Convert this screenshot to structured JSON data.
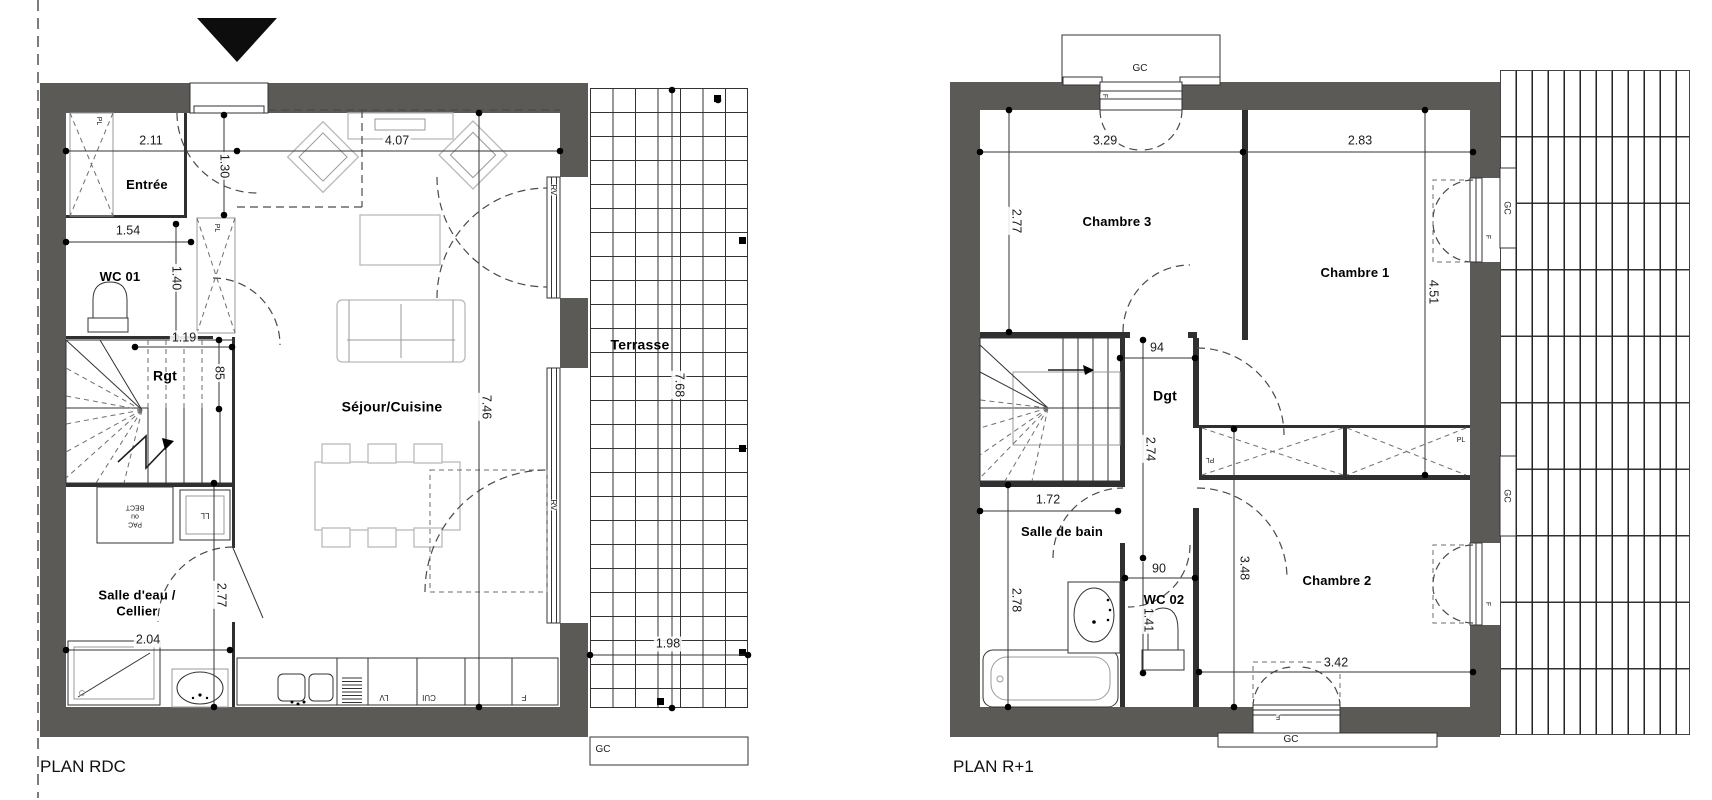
{
  "document": {
    "type": "architectural floor plan drawing",
    "units": "meters"
  },
  "colors": {
    "wall": "#5b5a57",
    "line": "#333333",
    "furniture": "#b9b9b9",
    "dim_text": "#1b1b1b",
    "background": "#ffffff"
  },
  "plans": [
    {
      "title": "PLAN RDC",
      "level": "ground floor",
      "rooms": [
        "Entrée",
        "WC 01",
        "Rgt",
        "Séjour/Cuisine",
        "Salle d'eau / Cellier",
        "Terrasse"
      ],
      "dimensions": [
        "2.11",
        "4.07",
        "1.30",
        "1.54",
        "1.40",
        "1.19",
        "85",
        "7.46",
        "2.77",
        "2.04",
        "7.68",
        "1.98"
      ],
      "equipment_codes": [
        "PL",
        "RV",
        "LL",
        "PAC ou BECT",
        "LV",
        "CUI",
        "F",
        "GC"
      ]
    },
    {
      "title": "PLAN R+1",
      "level": "first floor",
      "rooms": [
        "Chambre 3",
        "Chambre 1",
        "Chambre 2",
        "Dgt",
        "Salle de bain",
        "WC 02"
      ],
      "dimensions": [
        "3.29",
        "2.83",
        "2.77",
        "4.51",
        "94",
        "2.74",
        "1.72",
        "2.78",
        "90",
        "1.41",
        "3.48",
        "3.42"
      ],
      "equipment_codes": [
        "GC",
        "F",
        "PL"
      ]
    }
  ],
  "labels": {
    "rooms": [
      {
        "t": "Entrée",
        "x": 147,
        "y": 185
      },
      {
        "t": "WC 01",
        "x": 120,
        "y": 277
      },
      {
        "t": "Rgt",
        "x": 165,
        "y": 376,
        "fs": 14
      },
      {
        "t": "Séjour/Cuisine",
        "x": 392,
        "y": 407,
        "fs": 14
      },
      {
        "t": "Salle d'eau /\nCellier",
        "x": 137,
        "y": 603
      },
      {
        "t": "Terrasse",
        "x": 640,
        "y": 345,
        "fs": 14
      },
      {
        "t": "Chambre 3",
        "x": 1117,
        "y": 222
      },
      {
        "t": "Chambre 1",
        "x": 1355,
        "y": 273
      },
      {
        "t": "Chambre 2",
        "x": 1337,
        "y": 581
      },
      {
        "t": "Dgt",
        "x": 1165,
        "y": 396,
        "fs": 14
      },
      {
        "t": "Salle de bain",
        "x": 1062,
        "y": 532
      },
      {
        "t": "WC 02",
        "x": 1164,
        "y": 600
      }
    ],
    "dimensions": [
      {
        "t": "2.11",
        "x": 151,
        "y": 141
      },
      {
        "t": "4.07",
        "x": 397,
        "y": 141
      },
      {
        "t": "1.30",
        "x": 224,
        "y": 166,
        "r": 90
      },
      {
        "t": "1.54",
        "x": 128,
        "y": 231
      },
      {
        "t": "1.40",
        "x": 176,
        "y": 278,
        "r": 90
      },
      {
        "t": "1.19",
        "x": 184,
        "y": 338
      },
      {
        "t": "85",
        "x": 219,
        "y": 373,
        "r": 90
      },
      {
        "t": "7.46",
        "x": 486,
        "y": 407,
        "r": 90
      },
      {
        "t": "2.77",
        "x": 221,
        "y": 595,
        "r": 90
      },
      {
        "t": "2.04",
        "x": 148,
        "y": 640
      },
      {
        "t": "7.68",
        "x": 679,
        "y": 385,
        "r": 90
      },
      {
        "t": "1.98",
        "x": 668,
        "y": 644
      },
      {
        "t": "3.29",
        "x": 1105,
        "y": 141
      },
      {
        "t": "2.83",
        "x": 1360,
        "y": 141
      },
      {
        "t": "2.77",
        "x": 1016,
        "y": 221,
        "r": 90
      },
      {
        "t": "4.51",
        "x": 1433,
        "y": 292,
        "r": 90
      },
      {
        "t": "94",
        "x": 1157,
        "y": 348
      },
      {
        "t": "2.74",
        "x": 1150,
        "y": 449,
        "r": 90
      },
      {
        "t": "1.72",
        "x": 1048,
        "y": 500
      },
      {
        "t": "2.78",
        "x": 1016,
        "y": 600,
        "r": 90
      },
      {
        "t": "90",
        "x": 1159,
        "y": 569
      },
      {
        "t": "1.41",
        "x": 1148,
        "y": 620,
        "r": 90
      },
      {
        "t": "3.48",
        "x": 1244,
        "y": 568,
        "r": 90
      },
      {
        "t": "3.42",
        "x": 1336,
        "y": 663
      }
    ],
    "annotations": [
      {
        "t": "PL",
        "x": 98,
        "y": 121,
        "r": 90,
        "fs": 7
      },
      {
        "t": "PL",
        "x": 216,
        "y": 228,
        "r": 90,
        "fs": 7
      },
      {
        "t": "RV",
        "x": 553,
        "y": 190,
        "r": 90,
        "fs": 8
      },
      {
        "t": "RV",
        "x": 553,
        "y": 505,
        "r": 90,
        "fs": 8
      },
      {
        "t": "PAC\nou\nBECT",
        "x": 135,
        "y": 515,
        "r": 180,
        "fs": 7
      },
      {
        "t": "LL",
        "x": 205,
        "y": 515,
        "r": 180,
        "fs": 8
      },
      {
        "t": "LV",
        "x": 384,
        "y": 697,
        "r": 180,
        "fs": 8
      },
      {
        "t": "CUI",
        "x": 429,
        "y": 697,
        "r": 180,
        "fs": 8
      },
      {
        "t": "F",
        "x": 524,
        "y": 697,
        "r": 180,
        "fs": 8
      },
      {
        "t": "GC",
        "x": 603,
        "y": 750,
        "fs": 10
      },
      {
        "t": "GC",
        "x": 1140,
        "y": 69,
        "fs": 10
      },
      {
        "t": "F",
        "x": 1104,
        "y": 96,
        "r": 90,
        "fs": 7
      },
      {
        "t": "GC",
        "x": 1507,
        "y": 208,
        "r": 90,
        "fs": 9
      },
      {
        "t": "F",
        "x": 1487,
        "y": 237,
        "r": 90,
        "fs": 7
      },
      {
        "t": "GC",
        "x": 1507,
        "y": 496,
        "r": 90,
        "fs": 9
      },
      {
        "t": "F",
        "x": 1487,
        "y": 604,
        "r": 90,
        "fs": 7
      },
      {
        "t": "PL",
        "x": 1210,
        "y": 459,
        "r": 180,
        "fs": 7
      },
      {
        "t": "PL",
        "x": 1461,
        "y": 441,
        "fs": 7
      },
      {
        "t": "F",
        "x": 1278,
        "y": 716,
        "r": 180,
        "fs": 7
      },
      {
        "t": "GC",
        "x": 1291,
        "y": 740,
        "fs": 10
      }
    ]
  }
}
